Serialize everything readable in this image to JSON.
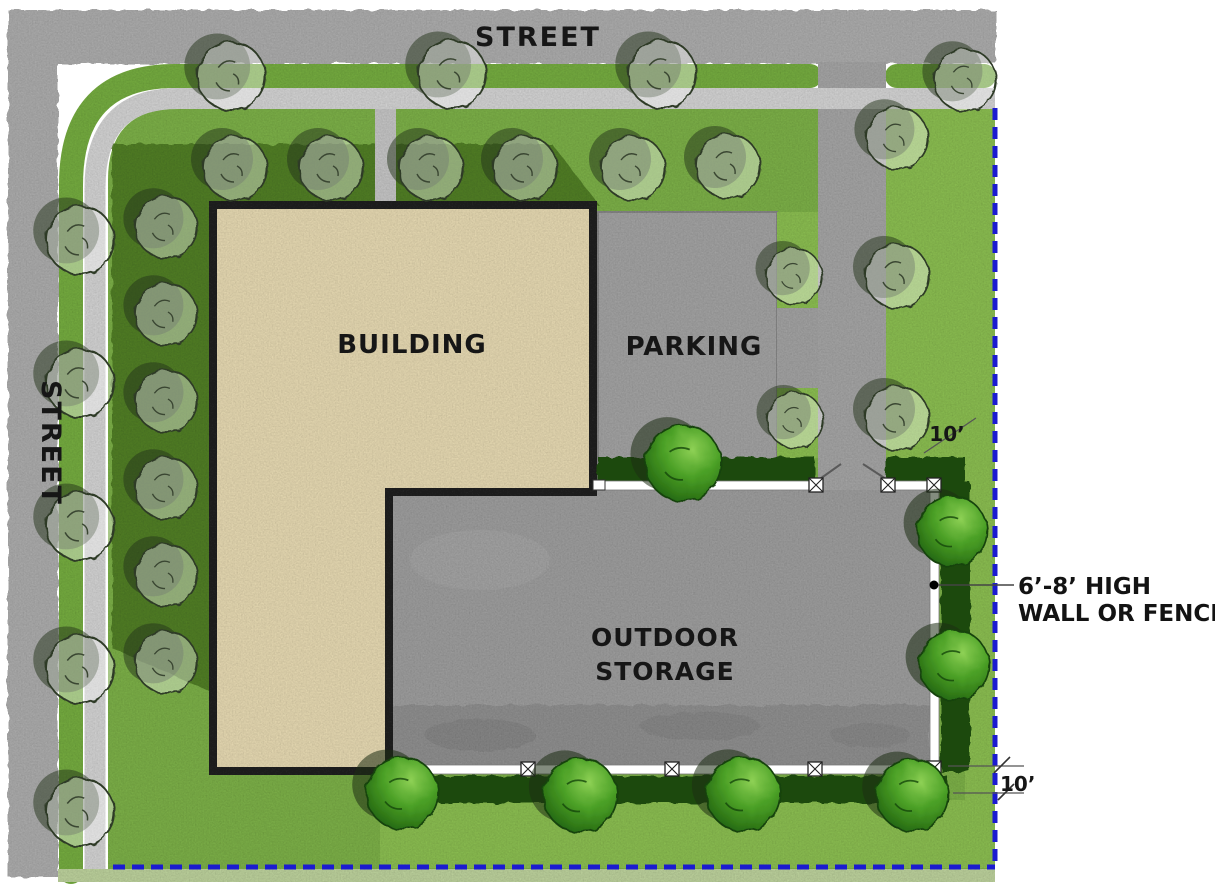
{
  "page": {
    "title": "Outdoor storage screening site plan"
  },
  "labels": {
    "street_top": "STREET",
    "street_left": "STREET",
    "building": "BUILDING",
    "parking": "PARKING",
    "storage_line1": "OUTDOOR",
    "storage_line2": "STORAGE"
  },
  "dimensions": {
    "east_buffer": "10’",
    "south_buffer": "10’"
  },
  "callout": {
    "line1": "6’-8’ HIGH",
    "line2": "WALL OR FENCE"
  },
  "colors": {
    "street": "#b5b5b5",
    "sidewalk": "#dedede",
    "walkway": "#cfcfcf",
    "lawn": "#83b94e",
    "lawn_bright": "#93c857",
    "lawn_pale": "#c6dca4",
    "lawn_shadow": "#4f7b27",
    "pavement": "#adadad",
    "parking": "#ababab",
    "storage": "#a6a6a6",
    "building_fill": "#f2e4bb",
    "building_outline": "#262626",
    "hedge": "#1a4a0f",
    "fence": "#ffffff",
    "property_line": "#1b1bd0",
    "text": "#161616"
  },
  "site": {
    "deciduous_trees": [
      [
        231,
        76,
        34
      ],
      [
        452,
        74,
        34
      ],
      [
        662,
        74,
        34
      ],
      [
        965,
        80,
        31
      ],
      [
        235,
        168,
        32
      ],
      [
        331,
        168,
        32
      ],
      [
        431,
        168,
        32
      ],
      [
        525,
        168,
        32
      ],
      [
        633,
        168,
        32
      ],
      [
        728,
        166,
        32
      ],
      [
        897,
        138,
        31
      ],
      [
        897,
        276,
        32
      ],
      [
        897,
        418,
        32
      ],
      [
        794,
        276,
        28
      ],
      [
        795,
        420,
        28
      ],
      [
        80,
        240,
        34
      ],
      [
        80,
        383,
        34
      ],
      [
        80,
        526,
        34
      ],
      [
        80,
        669,
        34
      ],
      [
        80,
        812,
        34
      ],
      [
        166,
        227,
        31
      ],
      [
        166,
        314,
        31
      ],
      [
        166,
        401,
        31
      ],
      [
        166,
        488,
        31
      ],
      [
        166,
        575,
        31
      ],
      [
        166,
        662,
        31
      ]
    ],
    "screen_trees": [
      [
        683,
        463,
        38
      ],
      [
        952,
        531,
        35
      ],
      [
        954,
        665,
        35
      ],
      [
        402,
        793,
        36
      ],
      [
        580,
        795,
        37
      ],
      [
        743,
        794,
        37
      ],
      [
        912,
        795,
        36
      ]
    ],
    "fence_posts": [
      [
        816,
        485
      ],
      [
        888,
        485
      ],
      [
        934,
        485
      ],
      [
        934,
        768
      ],
      [
        528,
        769
      ],
      [
        672,
        769
      ],
      [
        815,
        769
      ]
    ],
    "fence_caps": [
      [
        599,
        485
      ],
      [
        393,
        769
      ]
    ]
  }
}
